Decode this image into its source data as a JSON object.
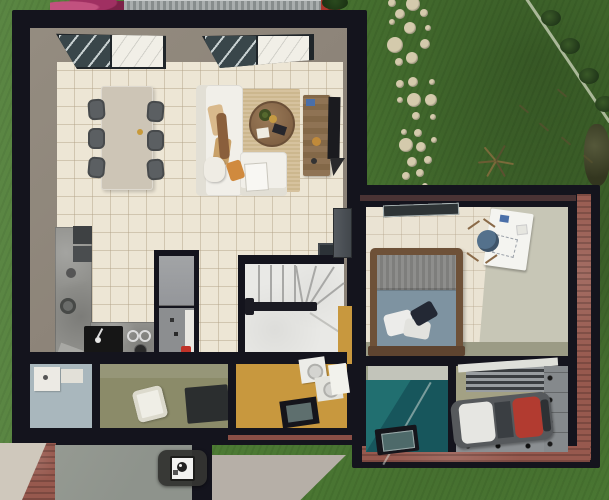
{
  "scene": {
    "description": "3D top-down render of a single-family house floor plan with garden, stepping-stone path, living/dining room, kitchen, winder staircase, two bathrooms, yellow hallway, brick-trimmed extension with bedroom and garage, and a camera viewpoint marker badge",
    "camera_badge": {
      "icon": "camera-icon"
    },
    "colors": {
      "grass": "#4E7D35",
      "wall": "#14141D",
      "taupe": "#8B8277",
      "cream": "#EDE6D5",
      "yellowFloor": "#C8983E",
      "oliveFloor": "#8B8B69",
      "blueFloor": "#A9B7BD",
      "tealWall": "#17565C",
      "tealLight": "#216F70",
      "garageFloor": "#A3A184",
      "counter": "#90908C",
      "stairs": "#E9E9E6",
      "stoneColor": "#D4CAAC",
      "brick": "#97594E",
      "sofa": "#F1EFE9",
      "rug": "#D6C29E",
      "woodLight": "#CDC5B6",
      "woodDark": "#6E5138",
      "duvet": "#7E93A1",
      "blanket": "#8E8E8C",
      "chairGray": "#5B5F62",
      "desk": "#F4F4F0",
      "chairBlue": "#54718C",
      "carBody": "#56595C",
      "carRed": "#B23B30",
      "concrete": "#8E938C",
      "concreteLight": "#B6AFA7",
      "sink": "#161616",
      "tv": "#1B1B1F",
      "glassDark": "#39464A",
      "bushMagenta": "#A03062",
      "bushRed": "#A8352C"
    },
    "stepping_stones": [
      [
        392,
        3,
        4
      ],
      [
        413,
        4,
        7
      ],
      [
        400,
        14,
        5
      ],
      [
        424,
        13,
        4
      ],
      [
        392,
        22,
        3
      ],
      [
        410,
        28,
        6
      ],
      [
        428,
        28,
        3
      ],
      [
        395,
        45,
        8
      ],
      [
        425,
        44,
        5
      ],
      [
        412,
        58,
        6
      ],
      [
        399,
        62,
        4
      ],
      [
        413,
        82,
        5
      ],
      [
        400,
        84,
        4
      ],
      [
        432,
        82,
        3
      ],
      [
        414,
        100,
        7
      ],
      [
        431,
        100,
        6
      ],
      [
        400,
        100,
        3
      ],
      [
        416,
        116,
        4
      ],
      [
        433,
        117,
        3
      ],
      [
        404,
        132,
        3
      ],
      [
        418,
        133,
        4
      ],
      [
        434,
        140,
        3
      ],
      [
        406,
        145,
        7
      ],
      [
        421,
        147,
        5
      ],
      [
        412,
        162,
        5
      ],
      [
        428,
        160,
        4
      ],
      [
        406,
        176,
        4
      ],
      [
        420,
        173,
        4
      ],
      [
        412,
        189,
        4
      ],
      [
        425,
        186,
        3
      ]
    ]
  }
}
